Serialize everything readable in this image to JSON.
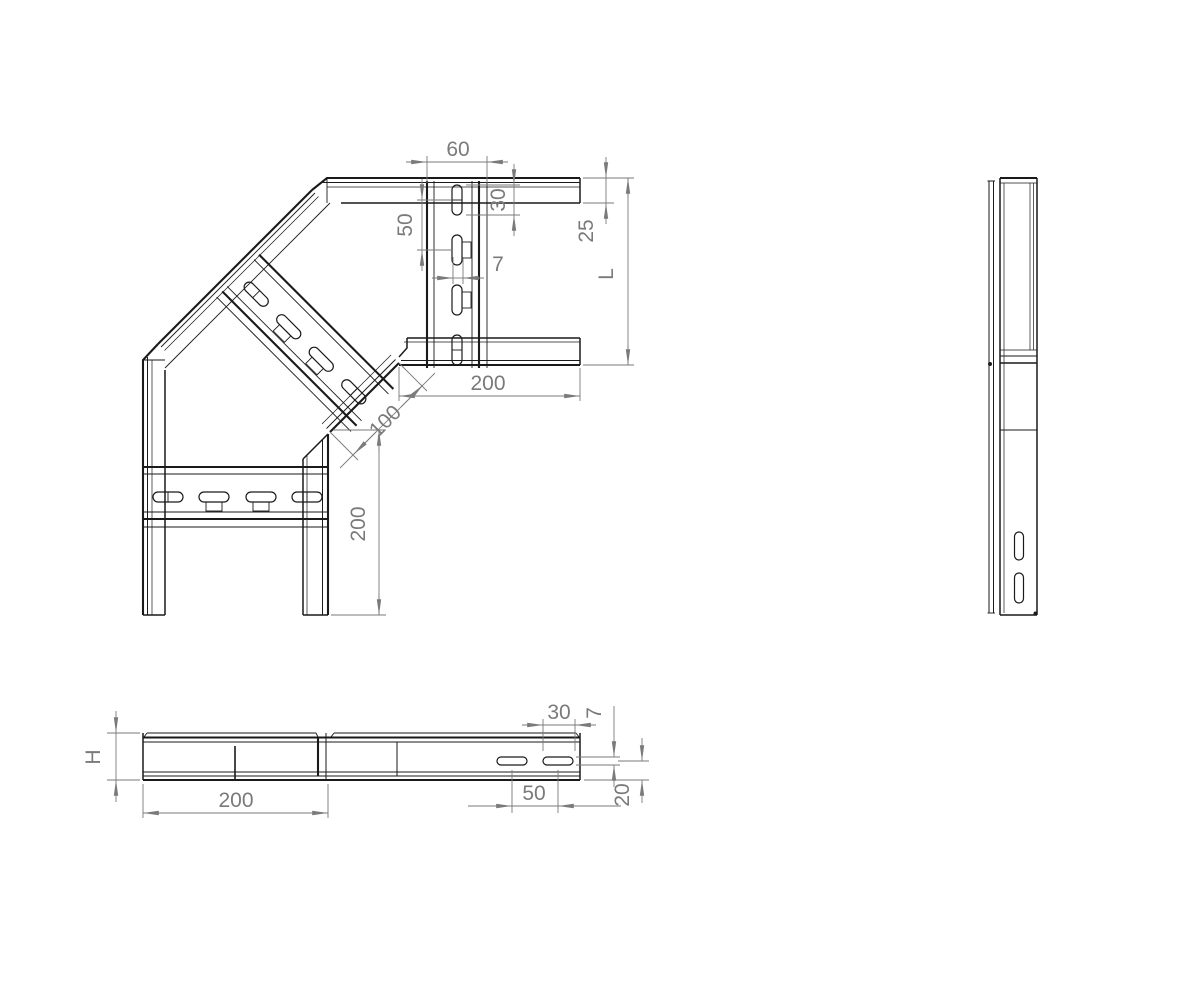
{
  "plan": {
    "dim_60": "60",
    "dim_30": "30",
    "dim_50": "50",
    "dim_7": "7",
    "dim_25": "25",
    "dim_L": "L",
    "dim_200_arm": "200",
    "dim_100": "100",
    "dim_200_leg": "200"
  },
  "front": {
    "dim_H": "H",
    "dim_200": "200",
    "dim_30": "30",
    "dim_7": "7",
    "dim_50": "50",
    "dim_20": "20"
  },
  "colors": {
    "background": "#ffffff",
    "geometry": "#1a1a1a",
    "dimension": "#7a7a7a",
    "centerline": "#2b2b9b"
  }
}
